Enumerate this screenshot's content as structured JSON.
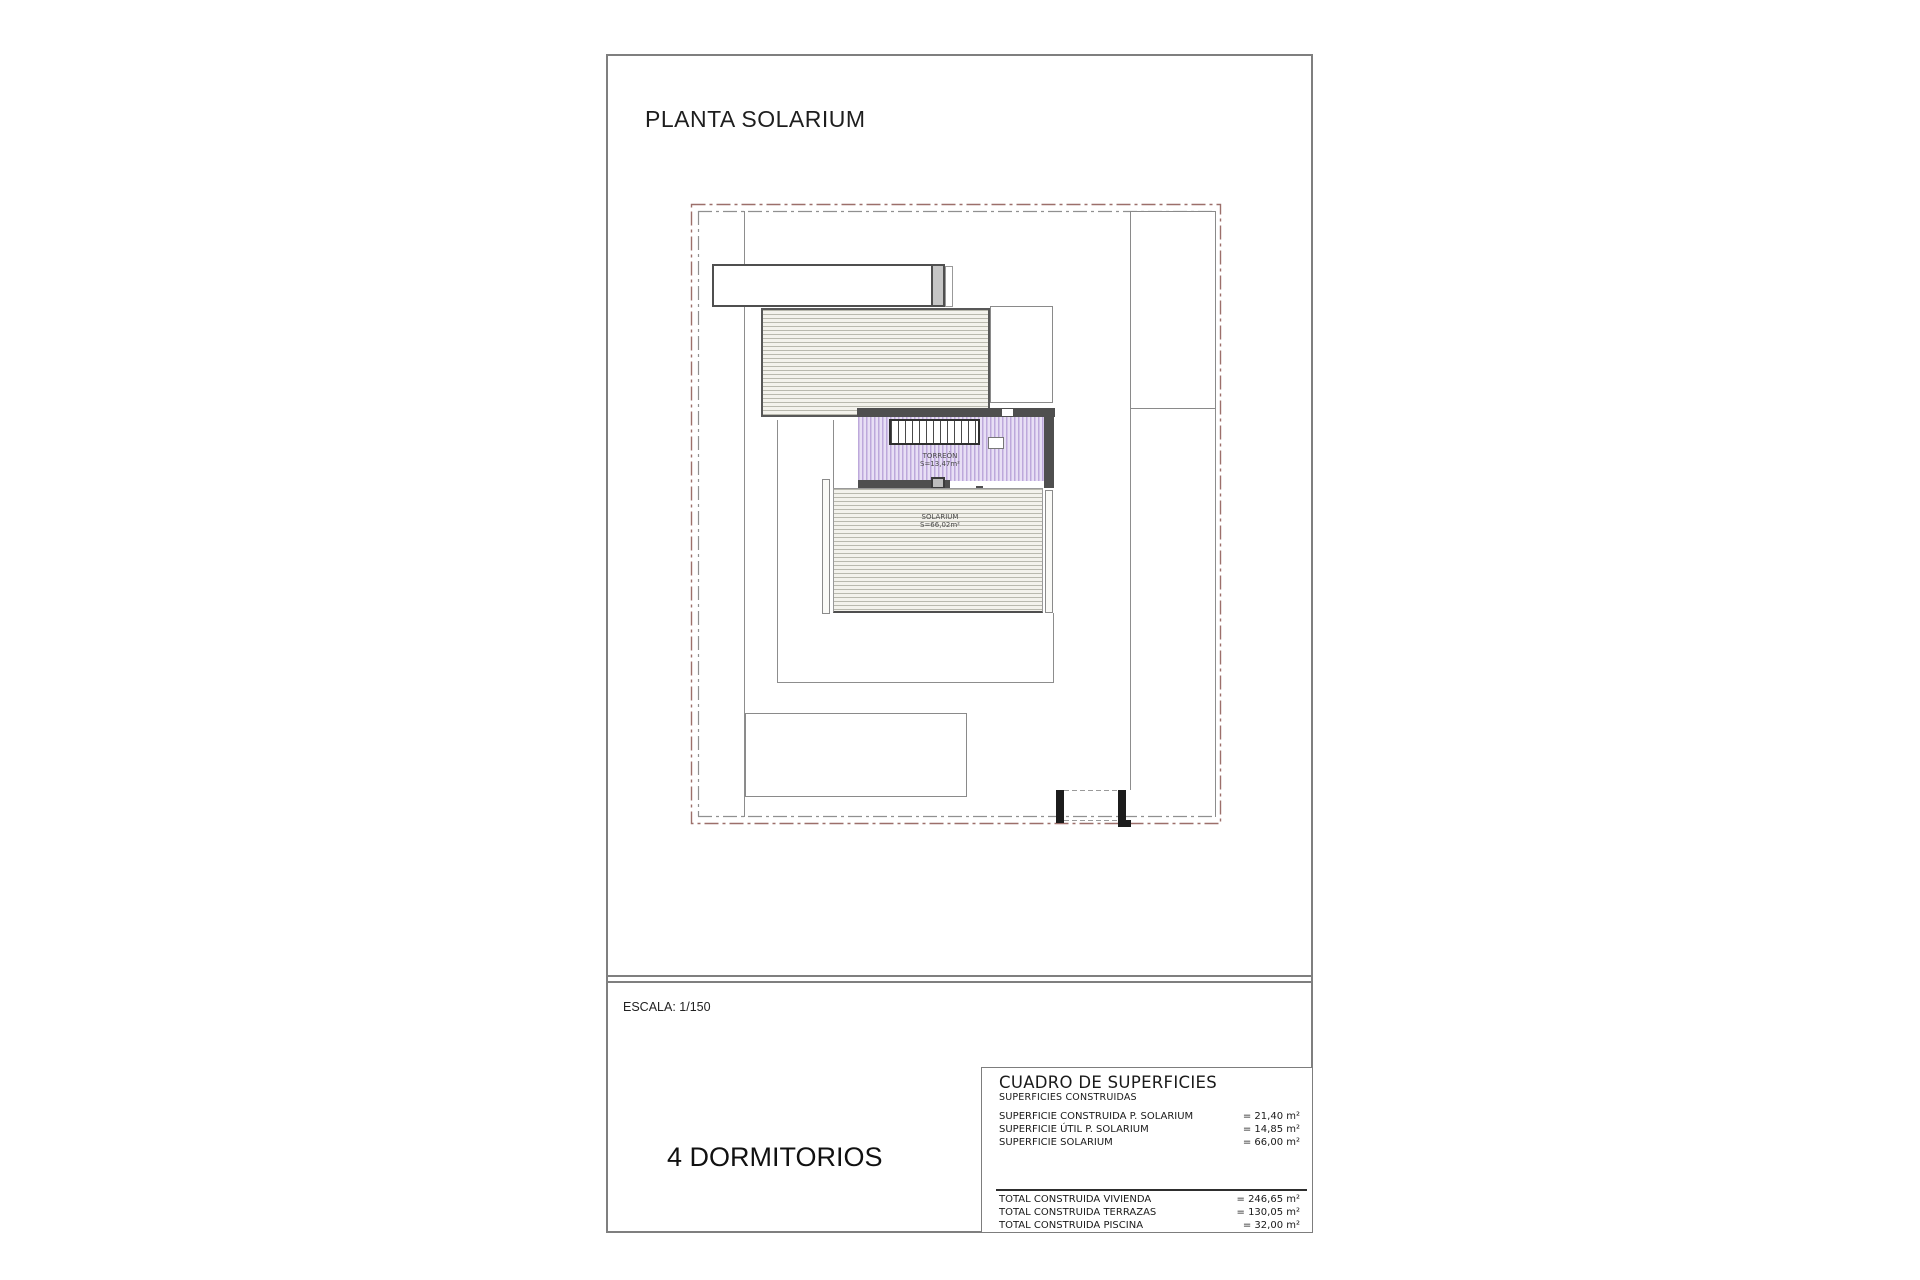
{
  "page": {
    "title": "PLANTA SOLARIUM",
    "scale_label": "ESCALA: 1/150",
    "bedrooms_label": "4 DORMITORIOS"
  },
  "plan": {
    "rooms": [
      {
        "name": "TORREÓN",
        "area": "S=13,47m²"
      },
      {
        "name": "SOLARIUM",
        "area": "S=66,02m²"
      }
    ]
  },
  "surfaces_table": {
    "title": "CUADRO DE SUPERFICIES",
    "subtitle": "SUPERFICIES CONSTRUIDAS",
    "rows": [
      {
        "label": "SUPERFICIE CONSTRUIDA P. SOLARIUM",
        "value": "= 21,40 m²"
      },
      {
        "label": "SUPERFICIE ÚTIL P. SOLARIUM",
        "value": "= 14,85 m²"
      },
      {
        "label": "SUPERFICIE SOLARIUM",
        "value": "= 66,00 m²"
      }
    ],
    "totals": [
      {
        "label": "TOTAL CONSTRUIDA VIVIENDA",
        "value": "= 246,65 m²"
      },
      {
        "label": "TOTAL CONSTRUIDA TERRAZAS",
        "value": "= 130,05 m²"
      },
      {
        "label": "TOTAL CONSTRUIDA PISCINA",
        "value": "= 32,00 m²"
      }
    ]
  },
  "colors": {
    "sheet_border": "#7f7f7f",
    "boundary_outer": "#9c6f6a",
    "boundary_inner": "#909090",
    "wall_dark": "#4f4f4f",
    "hatch_line": "#b9b9ae",
    "hatch_bg": "#f3f2ec",
    "purple_line": "#bda8db",
    "purple_bg": "#e8dff5"
  }
}
